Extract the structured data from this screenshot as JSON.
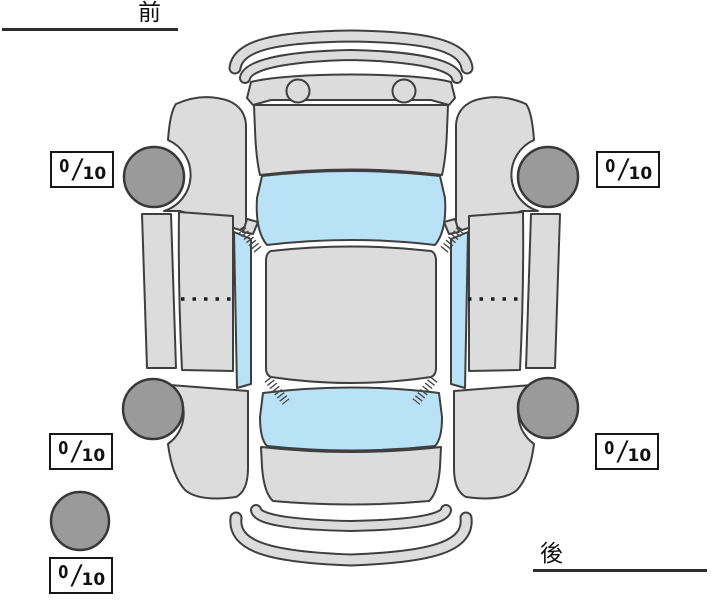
{
  "canvas": {
    "width": 711,
    "height": 600,
    "background": "#ffffff"
  },
  "labels": {
    "front": "前",
    "rear": "後"
  },
  "scores": {
    "front_left": {
      "value": "0",
      "slash": "/",
      "max": "10"
    },
    "front_right": {
      "value": "0",
      "slash": "/",
      "max": "10"
    },
    "rear_left": {
      "value": "0",
      "slash": "/",
      "max": "10"
    },
    "rear_right": {
      "value": "0",
      "slash": "/",
      "max": "10"
    },
    "spare": {
      "value": "0",
      "slash": "/",
      "max": "10"
    }
  },
  "diagram": {
    "description": "car-top-view-tire-tread-condition",
    "colors": {
      "body": "#dcdcdc",
      "window": "#b9e2f7",
      "tire": "#9a9a9a",
      "outline": "#3f3f3f",
      "text": "#111111"
    }
  }
}
